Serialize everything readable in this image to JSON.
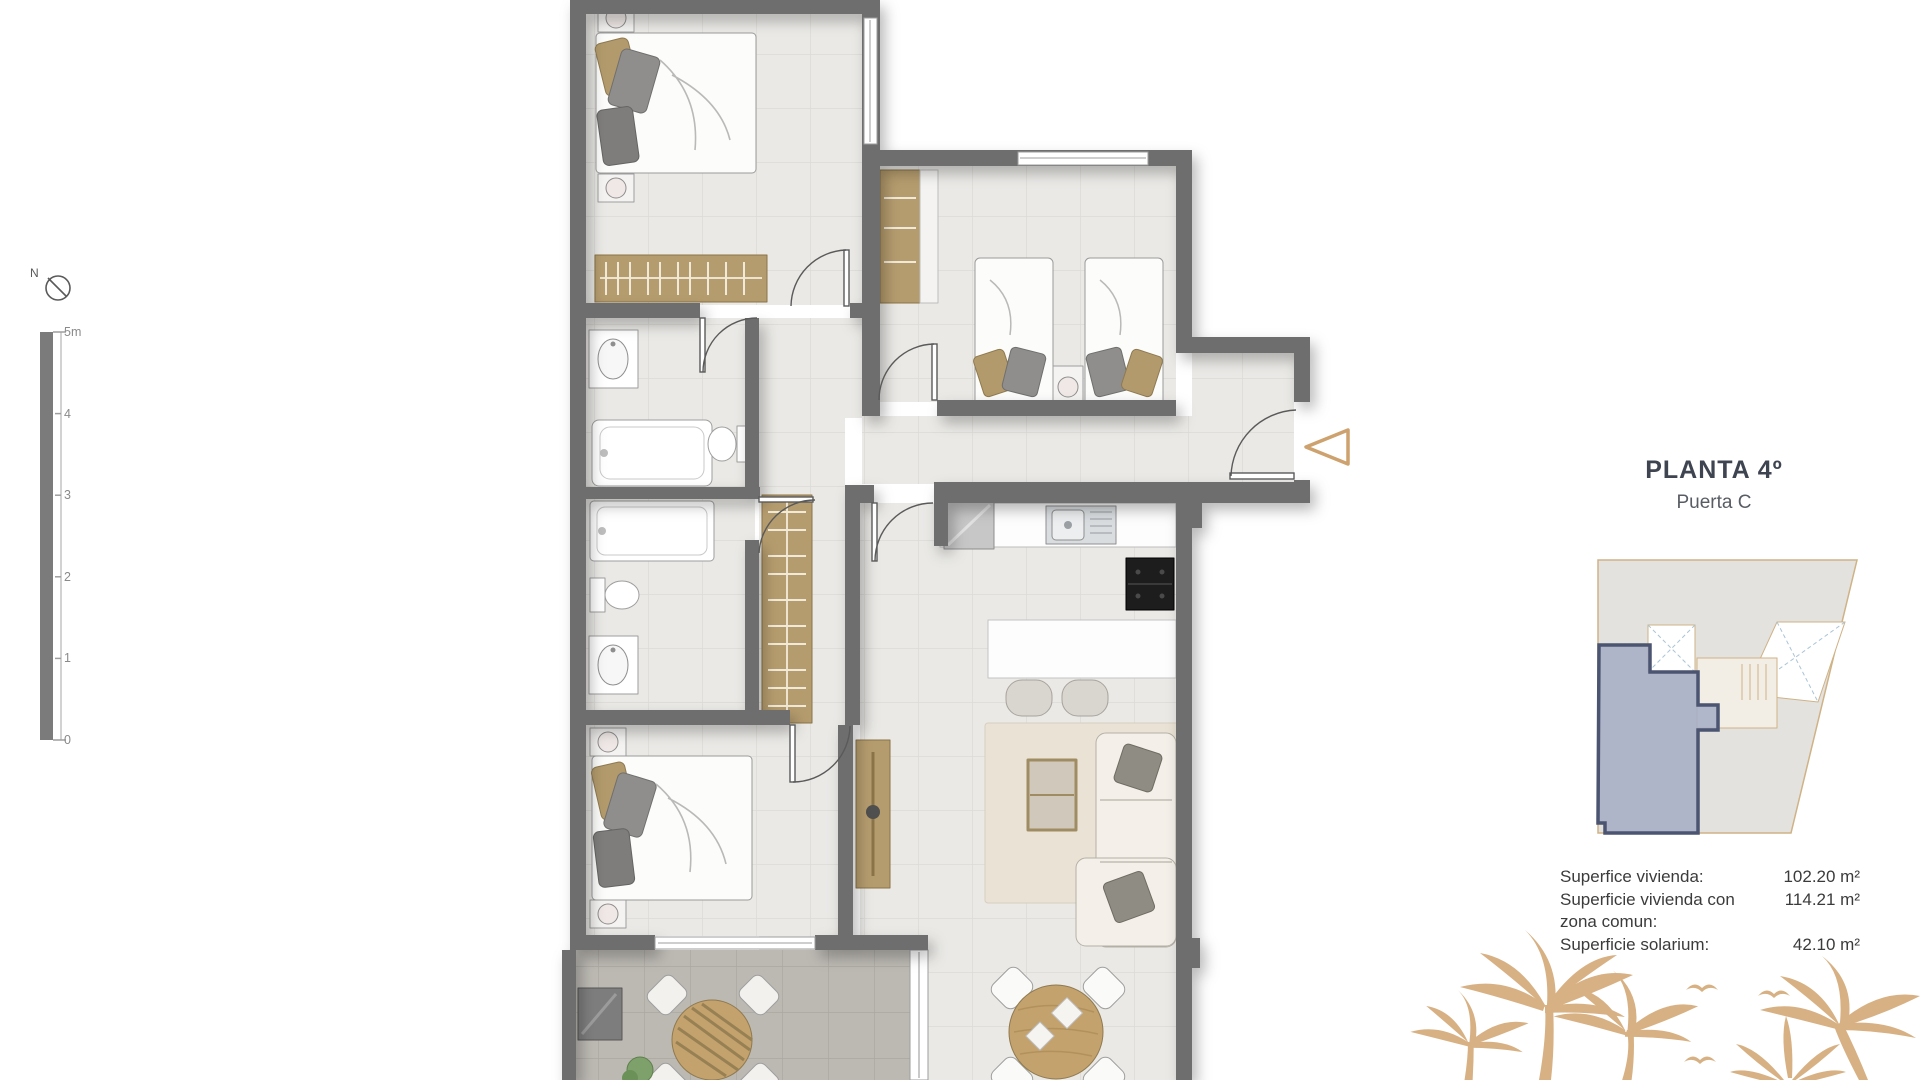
{
  "colors": {
    "wall": "#6e6e6e",
    "accent_tan": "#cda26e",
    "wood": "#b59c6e",
    "palm_tan": "#d7b183",
    "unit_highlight_fill": "#a4adc6",
    "unit_highlight_stroke": "#4b5470",
    "title_text": "#3e4450"
  },
  "compass": {
    "north_label": "N"
  },
  "scale_bar": {
    "ticks": [
      "5m",
      "4",
      "3",
      "2",
      "1",
      "0"
    ]
  },
  "title_block": {
    "title": "PLANTA 4º",
    "subtitle": "Puerta C"
  },
  "areas": {
    "rows": [
      {
        "label": "Superfice vivienda:",
        "value": "102.20 m²"
      },
      {
        "label": "Superficie vivienda con zona comun:",
        "value": "114.21 m²"
      },
      {
        "label": "Superficie solarium:",
        "value": "42.10 m²"
      }
    ]
  },
  "entrance_marker": {
    "shape": "triangle-arrow-left"
  }
}
